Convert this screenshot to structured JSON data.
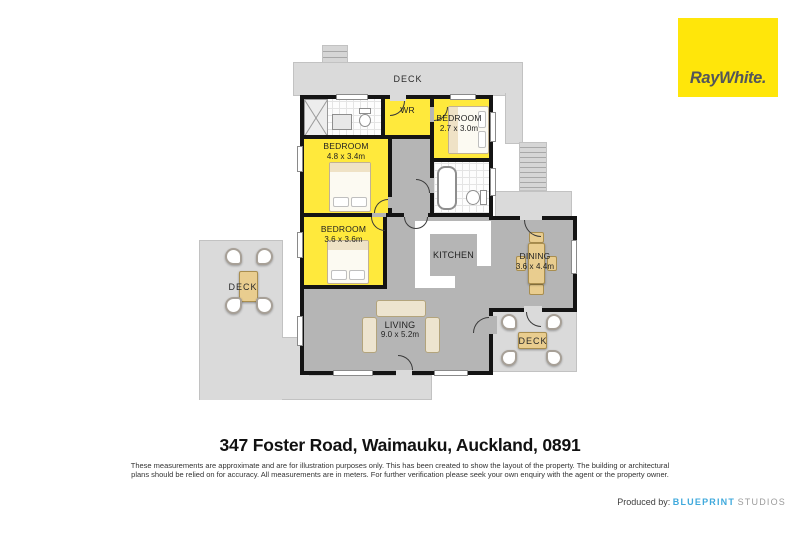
{
  "branding": {
    "agency_logo_text": "RayWhite.",
    "logo_bg_color": "#FFE60A",
    "logo_text_color": "#53565A"
  },
  "footer": {
    "address": "347 Foster Road, Waimauku, Auckland, 0891",
    "disclaimer_line1": "These measurements are approximate and are for illustration purposes only. This has been created to show the layout of the property. The building or architectural",
    "disclaimer_line2": "plans should be relied on for accuracy. All measurements are in meters. For further verification please seek your own enquiry with the agent or the property owner.",
    "produced_by_label": "Produced by:",
    "producer_name": "BLUEPRINT",
    "producer_suffix": "STUDIOS",
    "producer_brand_color": "#3FA9DC"
  },
  "floorplan": {
    "rooms": {
      "deck_top": {
        "label": "DECK"
      },
      "deck_left": {
        "label": "DECK"
      },
      "deck_right": {
        "label": "DECK"
      },
      "wr": {
        "label": "WR"
      },
      "bedroom1": {
        "label": "BEDROOM",
        "dims": "4.8 x 3.4m"
      },
      "bedroom2": {
        "label": "BEDROOM",
        "dims": "2.7 x 3.0m"
      },
      "bedroom3": {
        "label": "BEDROOM",
        "dims": "3.6 x 3.6m"
      },
      "kitchen": {
        "label": "KITCHEN"
      },
      "dining": {
        "label": "DINING",
        "dims": "3.6 x 4.4m"
      },
      "living": {
        "label": "LIVING",
        "dims": "9.0 x 5.2m"
      }
    },
    "colors": {
      "highlight_room": "#FFE93C",
      "floor": "#B5B5B5",
      "deck": "#DADADA",
      "wall": "#141414"
    }
  }
}
